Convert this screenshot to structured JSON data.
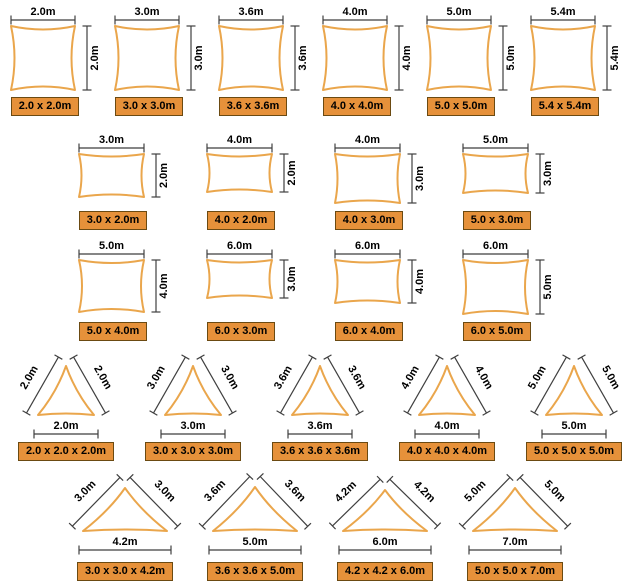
{
  "title": "shade-sail-size-chart",
  "colors": {
    "sail_stroke": "#EAA64C",
    "sail_fill": "#ffffff",
    "box_bg": "#E6913A",
    "box_border": "#6B4A12",
    "dim_line": "#3F3F3F",
    "dim_text": "#000000"
  },
  "rows": [
    {
      "name": "squares",
      "shape": "quad",
      "items": [
        {
          "w": 2.0,
          "h": 2.0,
          "top": "2.0m",
          "side": "2.0m",
          "box": "2.0 x 2.0m"
        },
        {
          "w": 3.0,
          "h": 3.0,
          "top": "3.0m",
          "side": "3.0m",
          "box": "3.0 x 3.0m"
        },
        {
          "w": 3.6,
          "h": 3.6,
          "top": "3.6m",
          "side": "3.6m",
          "box": "3.6 x 3.6m"
        },
        {
          "w": 4.0,
          "h": 4.0,
          "top": "4.0m",
          "side": "4.0m",
          "box": "4.0 x 4.0m"
        },
        {
          "w": 5.0,
          "h": 5.0,
          "top": "5.0m",
          "side": "5.0m",
          "box": "5.0 x 5.0m"
        },
        {
          "w": 5.4,
          "h": 5.4,
          "top": "5.4m",
          "side": "5.4m",
          "box": "5.4 x 5.4m"
        }
      ]
    },
    {
      "name": "rects-a",
      "shape": "quad",
      "items": [
        {
          "w": 3.0,
          "h": 2.0,
          "top": "3.0m",
          "side": "2.0m",
          "box": "3.0 x 2.0m"
        },
        {
          "w": 4.0,
          "h": 2.0,
          "top": "4.0m",
          "side": "2.0m",
          "box": "4.0 x 2.0m"
        },
        {
          "w": 4.0,
          "h": 3.0,
          "top": "4.0m",
          "side": "3.0m",
          "box": "4.0 x 3.0m"
        },
        {
          "w": 5.0,
          "h": 3.0,
          "top": "5.0m",
          "side": "3.0m",
          "box": "5.0 x 3.0m"
        }
      ]
    },
    {
      "name": "rects-b",
      "shape": "quad",
      "items": [
        {
          "w": 5.0,
          "h": 4.0,
          "top": "5.0m",
          "side": "4.0m",
          "box": "5.0 x 4.0m"
        },
        {
          "w": 6.0,
          "h": 3.0,
          "top": "6.0m",
          "side": "3.0m",
          "box": "6.0 x 3.0m"
        },
        {
          "w": 6.0,
          "h": 4.0,
          "top": "6.0m",
          "side": "4.0m",
          "box": "6.0 x 4.0m"
        },
        {
          "w": 6.0,
          "h": 5.0,
          "top": "6.0m",
          "side": "5.0m",
          "box": "6.0 x 5.0m"
        }
      ]
    },
    {
      "name": "tri-equal",
      "shape": "tri",
      "items": [
        {
          "a": 2.0,
          "base": 2.0,
          "left": "2.0m",
          "right": "2.0m",
          "bottom": "2.0m",
          "box": "2.0 x 2.0 x 2.0m"
        },
        {
          "a": 3.0,
          "base": 3.0,
          "left": "3.0m",
          "right": "3.0m",
          "bottom": "3.0m",
          "box": "3.0 x 3.0 x 3.0m"
        },
        {
          "a": 3.6,
          "base": 3.6,
          "left": "3.6m",
          "right": "3.6m",
          "bottom": "3.6m",
          "box": "3.6 x 3.6 x 3.6m"
        },
        {
          "a": 4.0,
          "base": 4.0,
          "left": "4.0m",
          "right": "4.0m",
          "bottom": "4.0m",
          "box": "4.0 x 4.0 x 4.0m"
        },
        {
          "a": 5.0,
          "base": 5.0,
          "left": "5.0m",
          "right": "5.0m",
          "bottom": "5.0m",
          "box": "5.0 x 5.0 x 5.0m"
        }
      ]
    },
    {
      "name": "tri-wide",
      "shape": "tri",
      "items": [
        {
          "a": 3.0,
          "base": 4.2,
          "left": "3.0m",
          "right": "3.0m",
          "bottom": "4.2m",
          "box": "3.0 x 3.0 x 4.2m"
        },
        {
          "a": 3.6,
          "base": 5.0,
          "left": "3.6m",
          "right": "3.6m",
          "bottom": "5.0m",
          "box": "3.6 x 3.6 x 5.0m"
        },
        {
          "a": 4.2,
          "base": 6.0,
          "left": "4.2m",
          "right": "4.2m",
          "bottom": "6.0m",
          "box": "4.2 x 4.2 x 6.0m"
        },
        {
          "a": 5.0,
          "base": 7.0,
          "left": "5.0m",
          "right": "5.0m",
          "bottom": "7.0m",
          "box": "5.0 x 5.0 x 7.0m"
        }
      ]
    }
  ]
}
